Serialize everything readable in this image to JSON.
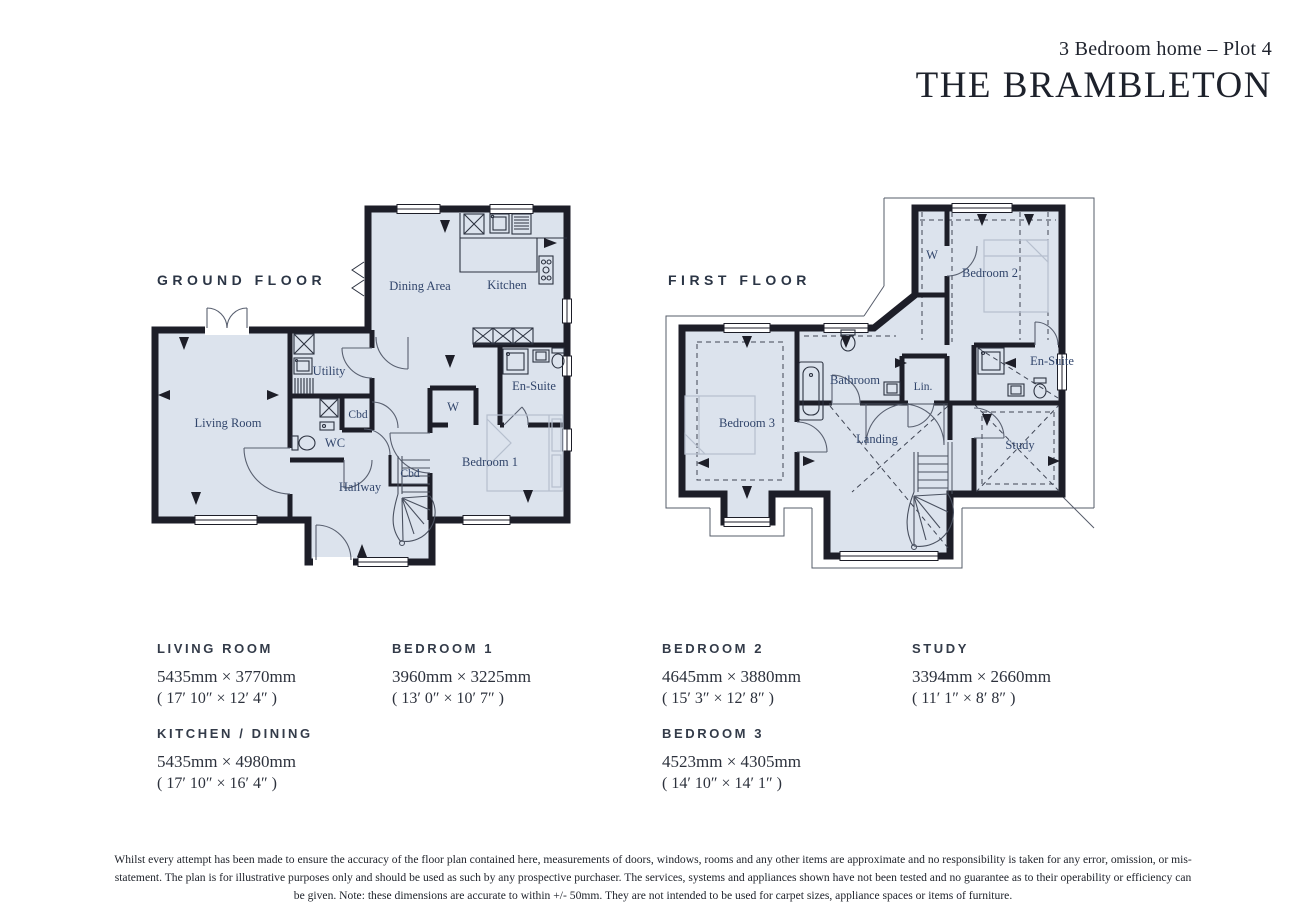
{
  "header": {
    "subtitle": "3 Bedroom home – Plot 4",
    "title": "THE BRAMBLETON"
  },
  "floors": {
    "ground": {
      "label": "GROUND FLOOR",
      "rooms": {
        "dining": "Dining Area",
        "kitchen": "Kitchen",
        "utility": "Utility",
        "cbd1": "Cbd",
        "wc": "WC",
        "wardrobe": "W",
        "ensuite": "En-Suite",
        "bedroom1": "Bedroom 1",
        "hallway": "Hallway",
        "cbd2": "Cbd",
        "living": "Living Room"
      }
    },
    "first": {
      "label": "FIRST FLOOR",
      "rooms": {
        "wardrobe": "W",
        "bedroom2": "Bedroom 2",
        "bathroom": "Bathroom",
        "bedroom3": "Bedroom 3",
        "linen": "Lin.",
        "landing": "Landing",
        "ensuite": "En-Suite",
        "study": "Study"
      }
    }
  },
  "dimensions": [
    {
      "name": "LIVING ROOM",
      "metric": "5435mm × 3770mm",
      "imperial": "( 17′ 10″ × 12′ 4″ )"
    },
    {
      "name": "BEDROOM 1",
      "metric": "3960mm × 3225mm",
      "imperial": "( 13′ 0″ × 10′ 7″ )"
    },
    {
      "name": "BEDROOM 2",
      "metric": "4645mm × 3880mm",
      "imperial": "( 15′ 3″ × 12′ 8″ )"
    },
    {
      "name": "STUDY",
      "metric": "3394mm × 2660mm",
      "imperial": "( 11′ 1″ × 8′ 8″ )"
    },
    {
      "name": "KITCHEN / DINING",
      "metric": "5435mm × 4980mm",
      "imperial": "( 17′ 10″ × 16′ 4″ )"
    },
    {
      "name": "BEDROOM 3",
      "metric": "4523mm × 4305mm",
      "imperial": "( 14′ 10″ × 14′ 1″ )"
    }
  ],
  "disclaimer": "Whilst every attempt has been made to ensure the accuracy of the floor plan contained here, measurements of doors, windows, rooms and any other items are approximate and no responsibility is taken for any error, omission, or mis-statement. The plan is for illustrative purposes only and should be used as such by any prospective purchaser. The services, systems and appliances shown have not been tested and no guarantee as to their operability or efficiency can be given. Note: these dimensions are accurate to within +/- 50mm. They are not intended to be used for carpet sizes, appliance spaces or items of furniture.",
  "palette": {
    "room_fill": "#dce3ed",
    "wall": "#1d1e28",
    "label_text": "#31456b",
    "heading_text": "#2b3545",
    "body_text": "#23272f"
  }
}
